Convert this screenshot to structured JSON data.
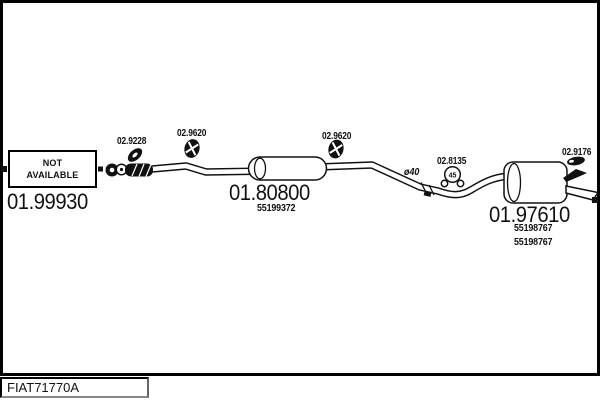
{
  "colors": {
    "ink": "#111111",
    "background": "#ffffff"
  },
  "not_available": {
    "line1": "NOT",
    "line2": "AVAILABLE"
  },
  "parts": {
    "front_section": {
      "code": "01.99930"
    },
    "gasket": {
      "code": "02.9228"
    },
    "hanger_front": {
      "code": "02.9620"
    },
    "hanger_mid": {
      "code": "02.9620"
    },
    "centre_muffler": {
      "code": "01.80800",
      "part_number": "55199372"
    },
    "pipe": {
      "diameter": "ø40"
    },
    "clamp": {
      "code": "02.8135",
      "size": "45"
    },
    "tail_trim": {
      "code": "02.9176"
    },
    "rear_muffler": {
      "code": "01.97610",
      "part_number_1": "55198767",
      "part_number_2": "55198767"
    }
  },
  "footer": {
    "drawing_code": "FIAT71770A"
  }
}
